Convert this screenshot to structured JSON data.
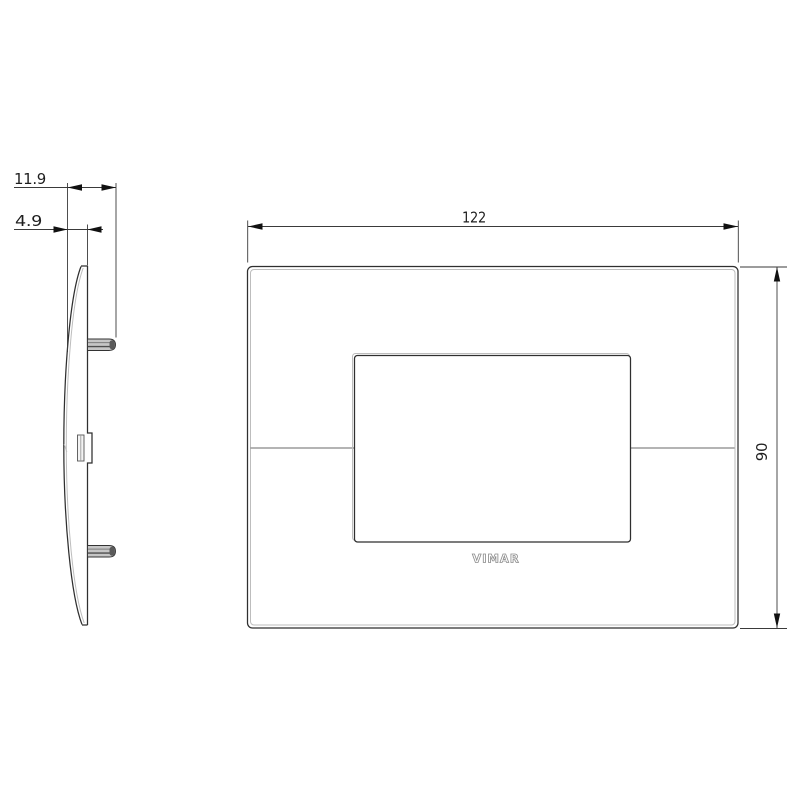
{
  "drawing": {
    "type": "technical-drawing",
    "subject": "wall cover plate, side profile and front view",
    "dims": {
      "depth_total": "11.9",
      "depth_plate": "4.9",
      "width": "122",
      "height": "90"
    },
    "brand": "VIMAR",
    "colors": {
      "line": "#2f2f2f",
      "dimension_line": "#3a3a3a",
      "edge_highlight": "#bdbdbd",
      "brand_outline": "#8f8f8f",
      "background": "#ffffff"
    }
  }
}
